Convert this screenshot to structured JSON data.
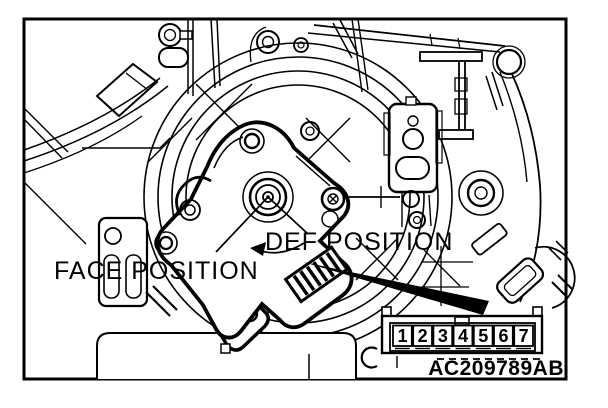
{
  "figure": {
    "type": "service-manual-line-drawing",
    "background_color": "#ffffff",
    "line_color": "#000000",
    "labels": {
      "face_position": "FACE POSITION",
      "def_position": "DEF POSITION"
    },
    "connector": {
      "pins": [
        "1",
        "2",
        "3",
        "4",
        "5",
        "6",
        "7"
      ]
    },
    "figure_code": "AC209789AB"
  }
}
